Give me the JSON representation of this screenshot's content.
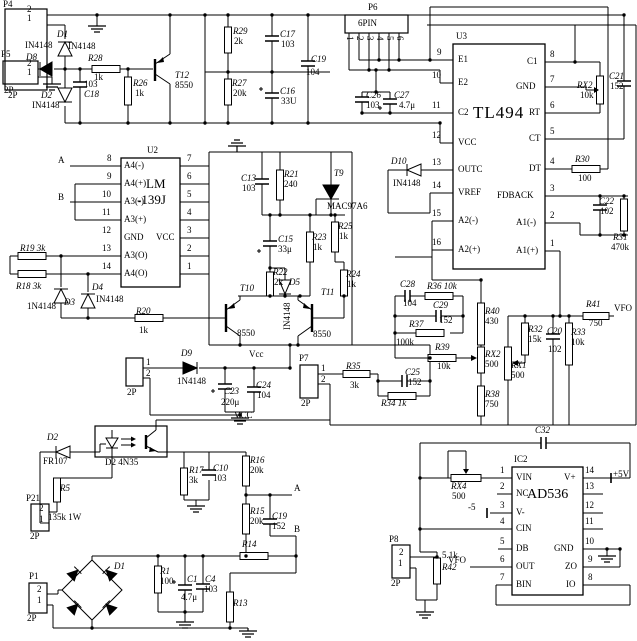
{
  "ics": {
    "U2": {
      "ref": "U2",
      "name1": "LM",
      "name2": "-139J",
      "left_pins": [
        {
          "num": "8",
          "label": "A4(-)"
        },
        {
          "num": "9",
          "label": "A4(+)"
        },
        {
          "num": "10",
          "label": "A3(-)"
        },
        {
          "num": "11",
          "label": "A3(+)"
        },
        {
          "num": "12",
          "label": "GND"
        },
        {
          "num": "13",
          "label": "A3(O)"
        },
        {
          "num": "14",
          "label": "A4(O)"
        }
      ],
      "right_pins": [
        {
          "num": "7",
          "label": ""
        },
        {
          "num": "6",
          "label": ""
        },
        {
          "num": "5",
          "label": ""
        },
        {
          "num": "4",
          "label": ""
        },
        {
          "num": "3",
          "label": "VCC"
        },
        {
          "num": "2",
          "label": ""
        },
        {
          "num": "1",
          "label": ""
        }
      ]
    },
    "U3": {
      "ref": "U3",
      "name": "TL494",
      "left_pins": [
        {
          "num": "9",
          "label": "E1"
        },
        {
          "num": "10",
          "label": "E2"
        },
        {
          "num": "11",
          "label": "C2"
        },
        {
          "num": "12",
          "label": "VCC"
        },
        {
          "num": "13",
          "label": "OUTC"
        },
        {
          "num": "14",
          "label": "VREF"
        },
        {
          "num": "15",
          "label": "A2(-)"
        },
        {
          "num": "16",
          "label": "A2(+)"
        }
      ],
      "right_pins": [
        {
          "num": "8",
          "label": "C1"
        },
        {
          "num": "7",
          "label": "GND"
        },
        {
          "num": "6",
          "label": "RT"
        },
        {
          "num": "5",
          "label": "CT"
        },
        {
          "num": "4",
          "label": "DT"
        },
        {
          "num": "3",
          "label": "FDBACK"
        },
        {
          "num": "2",
          "label": "A1(-)"
        },
        {
          "num": "1",
          "label": "A1(+)"
        }
      ]
    },
    "IC2": {
      "ref": "IC2",
      "name": "AD536",
      "left_pins": [
        {
          "num": "1",
          "label": "VIN"
        },
        {
          "num": "2",
          "label": "NC"
        },
        {
          "num": "3",
          "label": "V-"
        },
        {
          "num": "4",
          "label": "CIN"
        },
        {
          "num": "5",
          "label": "DB"
        },
        {
          "num": "6",
          "label": "OUT"
        },
        {
          "num": "7",
          "label": "BIN"
        }
      ],
      "right_pins": [
        {
          "num": "14",
          "label": "V+"
        },
        {
          "num": "13",
          "label": ""
        },
        {
          "num": "12",
          "label": ""
        },
        {
          "num": "11",
          "label": ""
        },
        {
          "num": "10",
          "label": "GND"
        },
        {
          "num": "9",
          "label": "ZO"
        },
        {
          "num": "8",
          "label": "IO"
        }
      ]
    }
  },
  "connectors": {
    "P4": {
      "ref": "P4",
      "type": "2P",
      "pins": [
        "2",
        "1"
      ]
    },
    "P5": {
      "ref": "P5",
      "type": "2P",
      "pins": [
        "2",
        "1"
      ]
    },
    "P6": {
      "ref": "P6",
      "type": "6PIN",
      "pins": [
        "1",
        "2",
        "3",
        "4",
        "5",
        "6"
      ]
    },
    "P7": {
      "ref": "P7",
      "type": "2P",
      "pins": [
        "1",
        "2"
      ]
    },
    "P8": {
      "ref": "P8",
      "type": "2P",
      "pins": [
        "2",
        "1"
      ]
    },
    "P21": {
      "ref": "P21",
      "type": "2P",
      "pins": [
        "2",
        "1"
      ]
    },
    "P1": {
      "ref": "P1",
      "type": "2P",
      "pins": [
        "2",
        "1"
      ]
    },
    "PX": {
      "ref": "",
      "type": "2P",
      "pins": [
        "1",
        "2"
      ]
    }
  },
  "components": {
    "r1": {
      "ref": "R1",
      "value": "100"
    },
    "r5": {
      "ref": "R5",
      "value": "135k 1W"
    },
    "r13": {
      "ref": "R13",
      "value": ""
    },
    "r14": {
      "ref": "R14",
      "value": ""
    },
    "r15": {
      "ref": "R15",
      "value": "20k"
    },
    "r16": {
      "ref": "R16",
      "value": "20k"
    },
    "r17": {
      "ref": "R17",
      "value": "3k"
    },
    "r18": {
      "text": "R18 3k"
    },
    "r19": {
      "text": "R19 3k"
    },
    "r20": {
      "ref": "R20",
      "value": "1k"
    },
    "r21": {
      "ref": "R21",
      "value": "240"
    },
    "r22": {
      "ref": "R22",
      "value": "2k"
    },
    "r23": {
      "ref": "R23",
      "value": "1k"
    },
    "r24": {
      "ref": "R24",
      "value": "1k"
    },
    "r25": {
      "ref": "R25",
      "value": "1k"
    },
    "r26": {
      "ref": "R26",
      "value": "1k"
    },
    "r27": {
      "ref": "R27",
      "value": "20k"
    },
    "r28": {
      "ref": "R28",
      "value": "1k"
    },
    "r29": {
      "ref": "R29",
      "value": "2k"
    },
    "r30": {
      "ref": "R30",
      "value": "100"
    },
    "r31": {
      "ref": "R31",
      "value": "470k"
    },
    "r32": {
      "ref": "R32",
      "value": "15k"
    },
    "r33": {
      "ref": "R33",
      "value": "10k"
    },
    "r34": {
      "text": "R34 1k"
    },
    "r35": {
      "ref": "R35",
      "value": "3k"
    },
    "r36": {
      "text": "R36 10k"
    },
    "r37": {
      "ref": "R37",
      "value": "100k"
    },
    "r38": {
      "ref": "R38",
      "value": "750"
    },
    "r39": {
      "ref": "R39",
      "value": "10k"
    },
    "r40": {
      "ref": "R40",
      "value": "430"
    },
    "r41": {
      "ref": "R41",
      "value": "750"
    },
    "r42": {
      "ref": "R42",
      "value": "5.1k"
    },
    "rx1": {
      "ref": "RX1",
      "value": "500"
    },
    "rx2a": {
      "ref": "RX2",
      "value": "10k"
    },
    "rx2b": {
      "ref": "RX2",
      "value": "500"
    },
    "rx4": {
      "ref": "RX4",
      "value": "500"
    },
    "c1": {
      "ref": "C1",
      "value": "4.7μ"
    },
    "c4": {
      "ref": "C4",
      "value": "103"
    },
    "c10": {
      "ref": "C10",
      "value": "103"
    },
    "c13": {
      "ref": "C13",
      "value": "103"
    },
    "c15": {
      "ref": "C15",
      "value": "33μ"
    },
    "c16": {
      "ref": "C16",
      "value": "33U"
    },
    "c17": {
      "ref": "C17",
      "value": "103"
    },
    "c18": {
      "ref": "C18",
      "value": "103"
    },
    "c19a": {
      "ref": "C19",
      "value": "104"
    },
    "c19b": {
      "ref": "C19",
      "value": "152"
    },
    "c20": {
      "ref": "C20",
      "value": "102"
    },
    "c21": {
      "ref": "C21",
      "value": "152"
    },
    "c22": {
      "ref": "C22",
      "value": "102"
    },
    "c23": {
      "ref": "C23",
      "value": "220μ"
    },
    "c24": {
      "ref": "C24",
      "value": "104"
    },
    "c25": {
      "ref": "C25",
      "value": "152"
    },
    "c26": {
      "ref": "C26",
      "value": "103"
    },
    "c27": {
      "ref": "C27",
      "value": "4.7μ"
    },
    "c28": {
      "ref": "C28",
      "value": "104"
    },
    "c29": {
      "ref": "C29",
      "value": "152"
    },
    "c32": {
      "ref": "C32",
      "value": ""
    },
    "d1": {
      "ref": "D1",
      "value": "IN4148"
    },
    "d2": {
      "ref": "D2",
      "value": "IN4148"
    },
    "d3": {
      "ref": "D3",
      "value": "1N4148"
    },
    "d4": {
      "ref": "D4",
      "value": "IN4148"
    },
    "d5": {
      "ref": "D5",
      "value": "IN4148"
    },
    "d8": {
      "ref": "D8",
      "value": "IN4148"
    },
    "d9": {
      "ref": "D9",
      "value": "1N4148"
    },
    "d10": {
      "ref": "D10",
      "value": "IN4148"
    },
    "d2fr": {
      "ref": "D2",
      "value": "FR107"
    },
    "d2opto": {
      "text": "D2 4N35"
    },
    "d1br": {
      "ref": "D1"
    },
    "t9": {
      "ref": "T9",
      "value": "MAC97A6"
    },
    "t10": {
      "ref": "T10",
      "value": "8550"
    },
    "t11": {
      "ref": "T11",
      "value": "8550"
    },
    "t12": {
      "ref": "T12",
      "value": "8550"
    }
  },
  "nets": {
    "a": "A",
    "b": "B",
    "vcc": "VCC",
    "vcc_mid": "Vcc",
    "vfo": "VFO",
    "p5": "+5V",
    "n5": "-5"
  }
}
